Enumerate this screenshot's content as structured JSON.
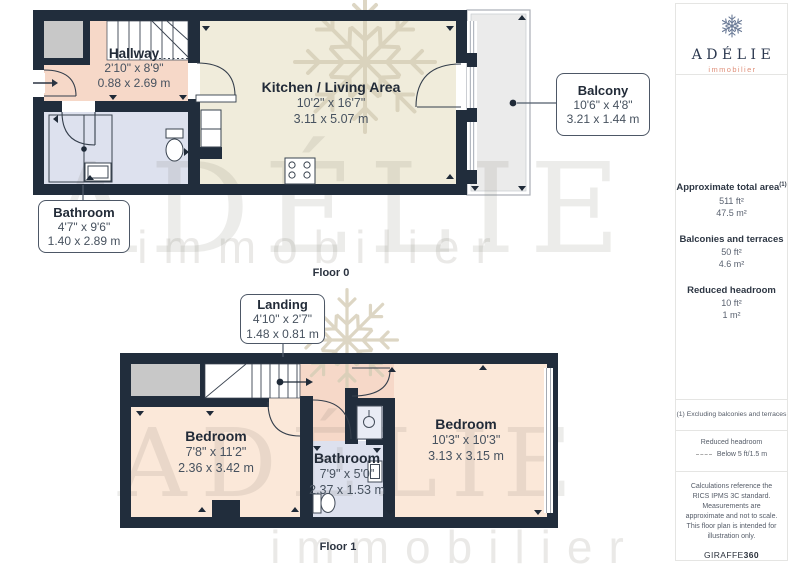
{
  "branding": {
    "logo_name": "ADÉLIE",
    "logo_tagline": "immobilier",
    "watermark_name": "ADÉLIE",
    "watermark_tagline": "immobilier"
  },
  "floor0": {
    "caption": "Floor 0",
    "hallway": {
      "name": "Hallway",
      "imperial": "2'10\" x 8'9\"",
      "metric": "0.88 x 2.69 m"
    },
    "kitchen_living": {
      "name": "Kitchen / Living Area",
      "imperial": "10'2\" x 16'7\"",
      "metric": "3.11 x 5.07 m"
    },
    "bathroom": {
      "name": "Bathroom",
      "imperial": "4'7\" x 9'6\"",
      "metric": "1.40 x 2.89 m"
    },
    "balcony": {
      "name": "Balcony",
      "imperial": "10'6\" x 4'8\"",
      "metric": "3.21 x 1.44 m"
    }
  },
  "floor1": {
    "caption": "Floor 1",
    "landing": {
      "name": "Landing",
      "imperial": "4'10\" x 2'7\"",
      "metric": "1.48 x 0.81 m"
    },
    "bedroom_left": {
      "name": "Bedroom",
      "imperial": "7'8\" x 11'2\"",
      "metric": "2.36 x 3.42 m"
    },
    "bathroom": {
      "name": "Bathroom",
      "imperial": "7'9\" x 5'0\"",
      "metric": "2.37 x 1.53 m"
    },
    "bedroom_right": {
      "name": "Bedroom",
      "imperial": "10'3\" x 10'3\"",
      "metric": "3.13 x 3.15 m"
    }
  },
  "sidebar": {
    "total_area": {
      "label": "Approximate total area",
      "footnote_marker": "(1)",
      "imperial": "511 ft²",
      "metric": "47.5 m²"
    },
    "balconies_terraces": {
      "label": "Balconies and terraces",
      "imperial": "50 ft²",
      "metric": "4.6 m²"
    },
    "reduced_headroom": {
      "label": "Reduced headroom",
      "imperial": "10 ft²",
      "metric": "1 m²"
    },
    "footnote": "(1) Excluding balconies and terraces",
    "legend": {
      "title": "Reduced headroom",
      "item": "Below 5 ft/1.5 m"
    },
    "disclaimer": "Calculations reference the RICS IPMS 3C standard. Measurements are approximate and not to scale. This floor plan is intended for illustration only.",
    "brand": {
      "giraffe": "GIRAFFE",
      "suffix": "360"
    }
  },
  "colors": {
    "wall": "#212d3c",
    "hallway_landing": "#f6d8c8",
    "kitchen": "#f0ecdb",
    "bathroom": "#dde1ee",
    "bedroom": "#fbe8d9",
    "balcony": "#ebebeb",
    "closet": "#c8c8c8",
    "logo_navy": "#2c3950",
    "logo_coral": "#df8f79"
  }
}
